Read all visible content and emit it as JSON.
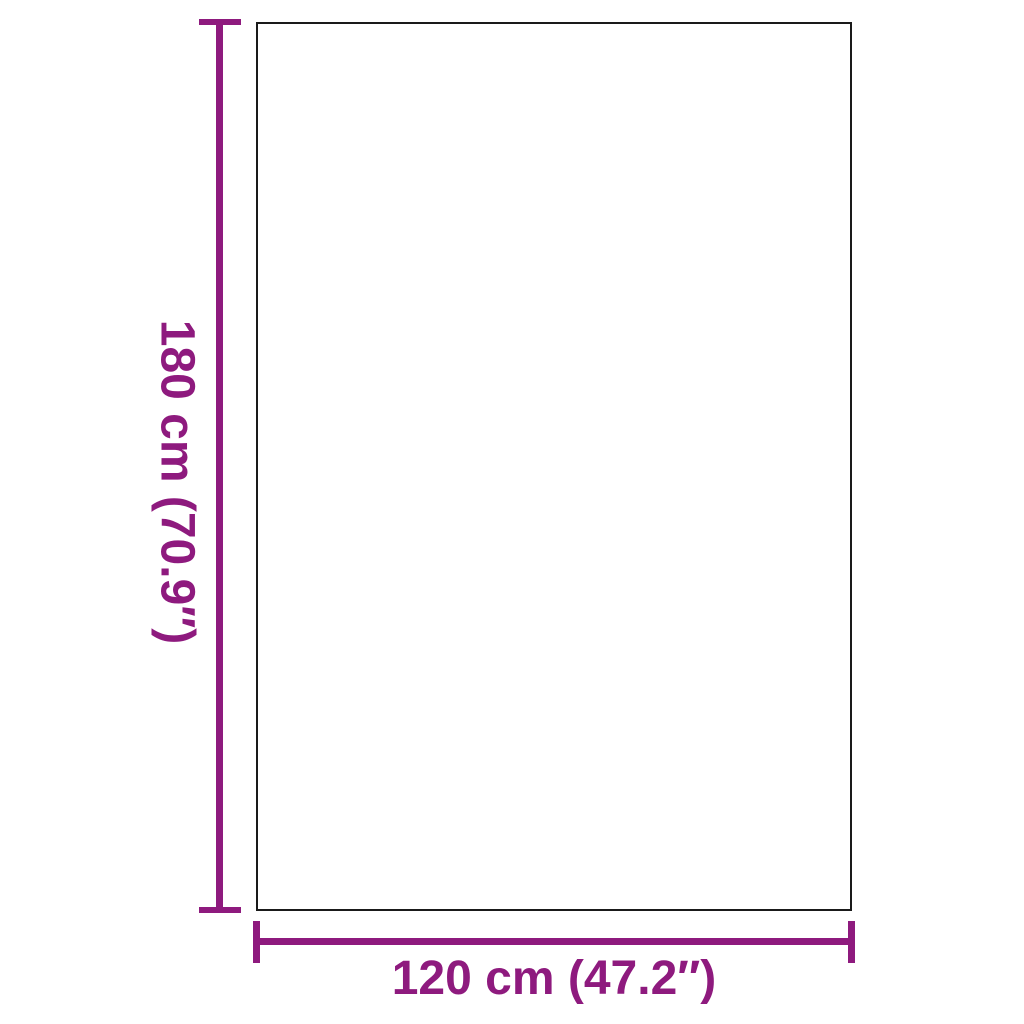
{
  "diagram": {
    "type": "product-dimension-diagram",
    "background": "#ffffff",
    "panel": {
      "shape": "rectangle",
      "fill": "#ffffff",
      "outline_color": "#1a1a1a"
    },
    "dimensions": {
      "height_label": "180 cm (70.9″)",
      "width_label": "120 cm (47.2″)"
    }
  },
  "colors": {
    "dimension": "#8E1A7E",
    "outline": "#1a1a1a"
  }
}
